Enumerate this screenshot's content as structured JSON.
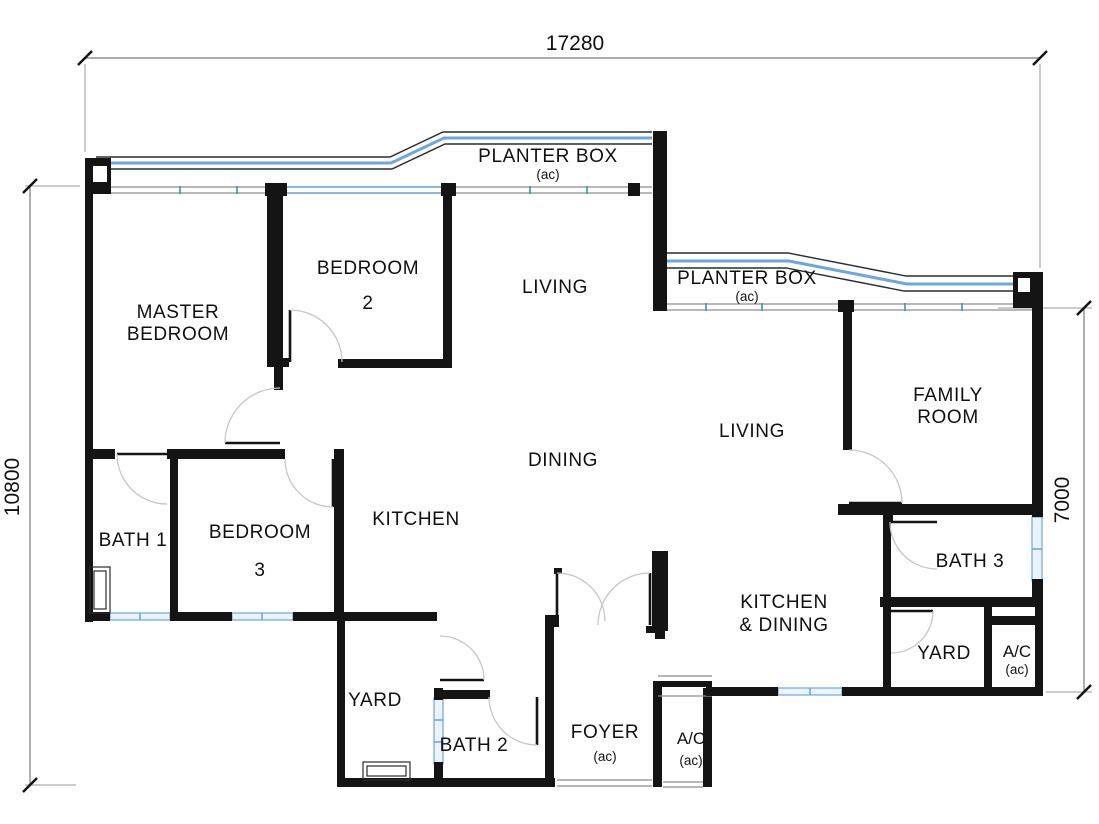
{
  "drawing": {
    "type": "apartment-floor-plan",
    "dimensions": {
      "overall_width": "17280",
      "overall_height_left": "10800",
      "right_wing_height": "7000"
    },
    "labels": {
      "planter_box": "PLANTER BOX",
      "ac_small": "(ac)",
      "master_l1": "MASTER",
      "master_l2": "BEDROOM",
      "bedroom2_l1": "BEDROOM",
      "bedroom2_l2": "2",
      "living_left": "LIVING",
      "living_right": "LIVING",
      "family_l1": "FAMILY",
      "family_l2": "ROOM",
      "dining": "DINING",
      "kitchen": "KITCHEN",
      "bath1": "BATH 1",
      "bedroom3_l1": "BEDROOM",
      "bedroom3_l2": "3",
      "bath3": "BATH 3",
      "kitchen_dining_l1": "KITCHEN",
      "kitchen_dining_l2": "& DINING",
      "yard_right": "YARD",
      "yard_left": "YARD",
      "ac": "A/C",
      "foyer": "FOYER",
      "bath2": "BATH 2"
    },
    "colors": {
      "wall": "#141414",
      "glazing_blue": "#6ea7dd",
      "window_fill": "#eaf3fc",
      "mullion_teal": "#2f9e9e",
      "dimension_line": "#7a7a7a",
      "door_arc": "#c6c6c6"
    }
  }
}
